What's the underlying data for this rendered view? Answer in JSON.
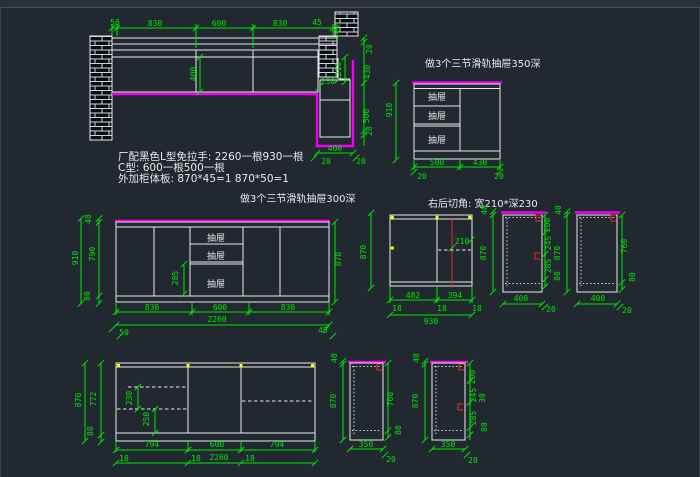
{
  "colors": {
    "background": "#212830",
    "line_white": "#e9e9e9",
    "dimension_green": "#00e800",
    "handle_magenta": "#f000f0",
    "marker_red": "#ff2222",
    "marker_yellow": "#ffff00"
  },
  "notes": {
    "line1": "厂配黑色L型免拉手: 2260一根930一根",
    "line2": "C型: 600一根500一根",
    "line3": "外加柜体板: 870*45=1    870*50=1"
  },
  "d1": {
    "top_dims": [
      "50",
      "830",
      "600",
      "830",
      "45"
    ],
    "inner_depth": "400",
    "niche_width": "230",
    "niche_height": "210",
    "right_chain": [
      "20",
      "430",
      "500",
      "20"
    ],
    "bottom_width": "400",
    "bottom_offsets": [
      "20",
      "20"
    ]
  },
  "d2": {
    "title": "做3个三节滑轨抽屉350深",
    "height": "910",
    "drawers": [
      "抽屉",
      "抽屉",
      "抽屉"
    ],
    "bottom_dims": [
      "500",
      "430"
    ],
    "bottom_offsets": [
      "20",
      "20"
    ]
  },
  "d3": {
    "title": "做3个三节滑轨抽屉300深",
    "left_chain": [
      "40",
      "790",
      "80"
    ],
    "height_total": "910",
    "right_height": "870",
    "drawer_height": "285",
    "drawers": [
      "抽屉",
      "抽屉",
      "抽屉"
    ],
    "bottom_dims": [
      "830",
      "600",
      "830"
    ],
    "total_width": "2260",
    "end_offsets": [
      "50",
      "45"
    ]
  },
  "d4": {
    "title": "右后切角: 宽210*深230",
    "height": "870",
    "cut_width": "210",
    "bottom_dims": [
      "482",
      "394"
    ],
    "thickness": [
      "18",
      "18",
      "18"
    ],
    "total_width": "930"
  },
  "d5": {
    "top": "40",
    "height": "870",
    "right_chain": [
      "200",
      "245",
      "285",
      "80"
    ],
    "width": "400",
    "offset": "20"
  },
  "d6": {
    "top": "40",
    "height": "870",
    "right_dims": [
      "760",
      "80"
    ],
    "width": "400",
    "offset": "20"
  },
  "d7": {
    "height": "870",
    "inner_height": "772",
    "base": "80",
    "notch_dims": [
      "230",
      "250"
    ],
    "bottom_dims": [
      "794",
      "600",
      "794"
    ],
    "thickness": [
      "18",
      "18",
      "18"
    ],
    "total_width": "2260"
  },
  "d8": {
    "top": "40",
    "height": "870",
    "right_dims": [
      "760",
      "80"
    ],
    "width": "350",
    "offset": "20"
  },
  "d9": {
    "top": "40",
    "height": "870",
    "right_chain": [
      "200",
      "245",
      "30",
      "285",
      "80"
    ],
    "width": "350",
    "offset": "20"
  }
}
